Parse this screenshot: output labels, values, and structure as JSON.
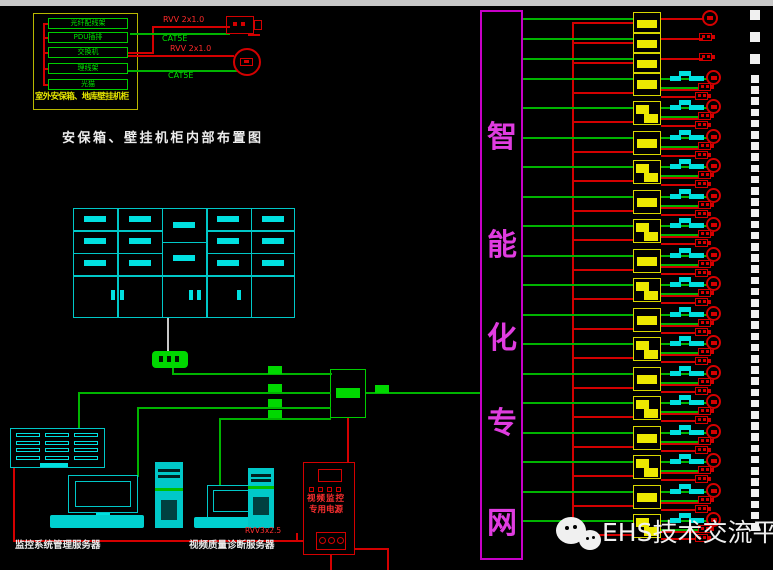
{
  "colors": {
    "green": "#00b400",
    "green_bright": "#00d800",
    "cyan": "#00c8c8",
    "cyan_bright": "#00e0e0",
    "yellow": "#d8d800",
    "yellow_bright": "#ece800",
    "red": "#d40000",
    "red_bright": "#ff2a2a",
    "magenta": "#c800c8",
    "magenta_text": "#e03ce0",
    "white": "#ececec",
    "strip": "#c8c8c8"
  },
  "top_left": {
    "caption": "室外安保箱、地库壁挂机柜",
    "title": "安保箱、壁挂机柜内部布置图",
    "modules": [
      "光纤配线架",
      "PDU插排",
      "交换机",
      "理线架",
      "光猫"
    ],
    "cables": [
      {
        "label": "RVV 2x1.0"
      },
      {
        "label": "CAT5E"
      },
      {
        "label": "RVV 2x1.0"
      },
      {
        "label": "CAT5E"
      }
    ],
    "icons": [
      "box-camera-icon",
      "dome-camera-icon"
    ]
  },
  "tv_wall": {
    "type": "monitor-wall-cabinet",
    "columns": 5
  },
  "backbone": {
    "label": "智能化专网",
    "chars": [
      "智",
      "能",
      "化",
      "专",
      "网"
    ]
  },
  "power_box": {
    "line1": "视频监控",
    "line2": "专用电源",
    "cable_note": "RVV3x2.5"
  },
  "servers": [
    {
      "label": "监控系统管理服务器"
    },
    {
      "label": "视频质量诊断服务器"
    }
  ],
  "right_field": {
    "simple_rows": [
      {
        "y": 18,
        "icon": "dome"
      },
      {
        "y": 38,
        "icon": "box"
      },
      {
        "y": 58,
        "icon": "box"
      }
    ],
    "zigzag_rows": [
      78,
      107,
      137,
      166,
      196,
      225,
      255,
      284,
      314,
      343,
      373,
      402,
      432,
      461,
      491,
      520
    ]
  },
  "dash_column": {
    "big_ys": [
      10,
      32,
      54
    ],
    "small_start": 75,
    "small_step": 11.2,
    "small_count": 41
  },
  "watermark": {
    "text": "EHS技术交流平台",
    "icon": "wechat-icon"
  }
}
